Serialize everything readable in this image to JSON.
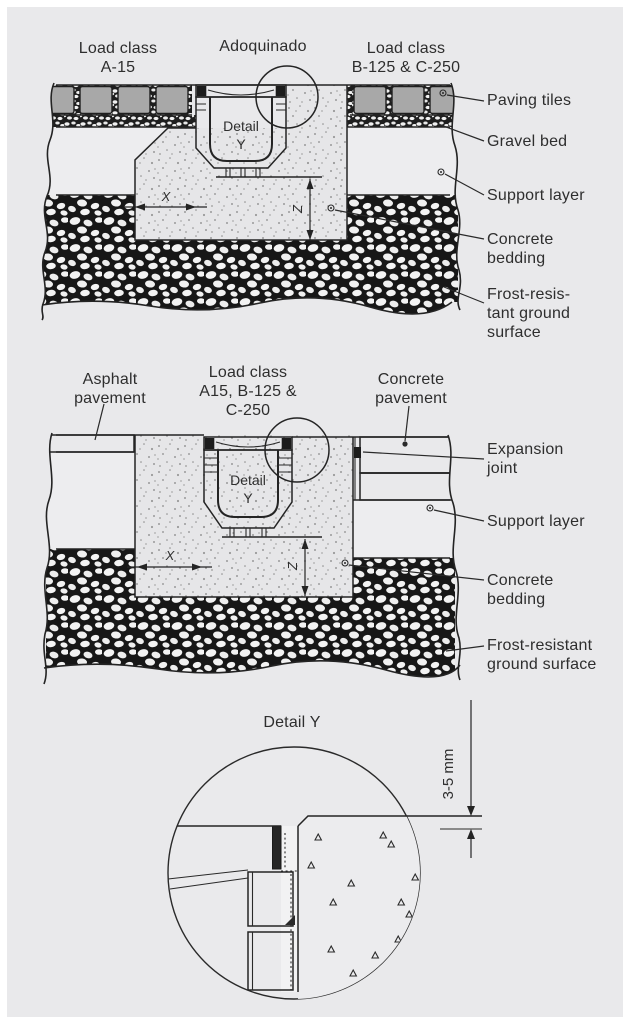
{
  "colors": {
    "background": "#e9e9eb",
    "line": "#242424",
    "paving_tile": "#a8a8a8",
    "asphalt": "#161616",
    "text": "#2e2e2e"
  },
  "d1": {
    "title_left": [
      "Load class",
      "A-15"
    ],
    "title_center": "Adoquinado",
    "title_right": [
      "Load class",
      "B-125 & C-250"
    ],
    "detail_marker": [
      "Detail",
      "Y"
    ],
    "dim_x": "X",
    "dim_z": "Z",
    "callout_paving_tiles": "Paving tiles",
    "callout_gravel_bed": "Gravel bed",
    "callout_support_layer": "Support layer",
    "callout_concrete_bedding": [
      "Concrete",
      "bedding"
    ],
    "callout_frost": [
      "Frost-resis-",
      "tant ground",
      "surface"
    ]
  },
  "d2": {
    "title_left": [
      "Asphalt",
      "pavement"
    ],
    "title_center": [
      "Load class",
      "A15, B-125 &",
      "C-250"
    ],
    "title_right": [
      "Concrete",
      "pavement"
    ],
    "detail_marker": [
      "Detail",
      "Y"
    ],
    "dim_x": "X",
    "dim_z": "Z",
    "callout_expansion_joint": [
      "Expansion",
      "joint"
    ],
    "callout_support_layer": "Support layer",
    "callout_concrete_bedding": [
      "Concrete",
      "bedding"
    ],
    "callout_frost": [
      "Frost-resistant",
      "ground surface"
    ]
  },
  "d3": {
    "title": "Detail Y",
    "dimension_label": "3-5 mm"
  }
}
